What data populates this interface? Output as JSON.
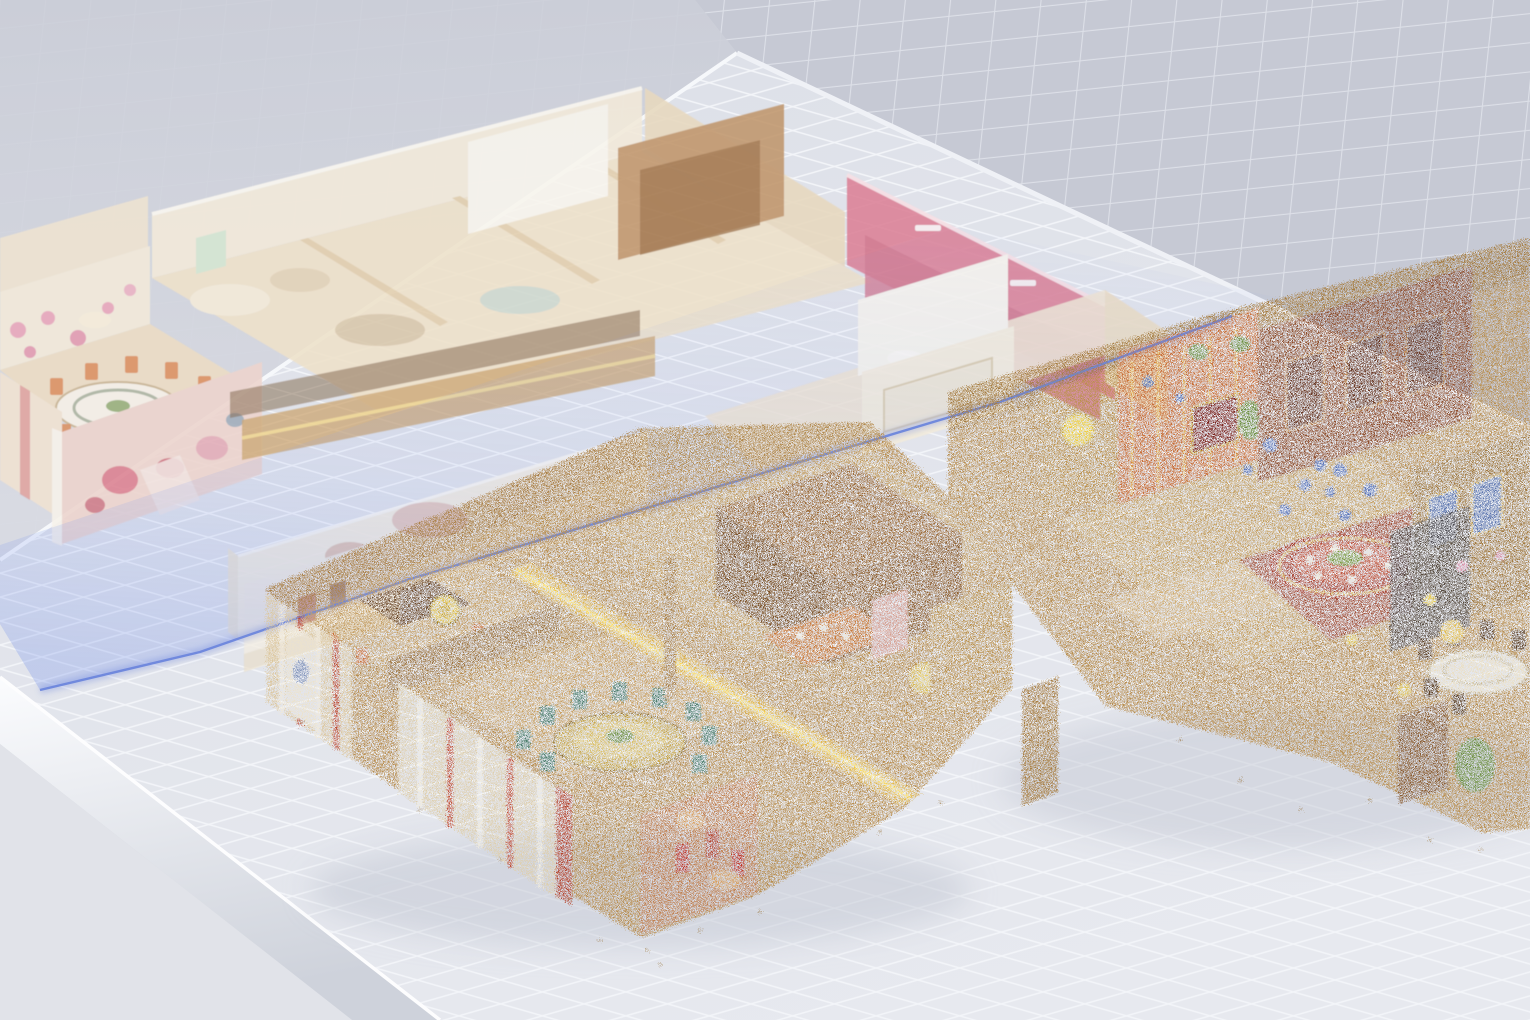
{
  "app": {
    "name": "3d-scan-viewer",
    "view": "dollhouse-split-floor-view"
  },
  "scene": {
    "models": [
      {
        "id": "upper-floor",
        "kind": "textured-mesh-faded"
      },
      {
        "id": "lower-floor",
        "kind": "point-cloud"
      }
    ],
    "slice_plane": {
      "id": "floor-slice-plane"
    }
  },
  "colors": {
    "backdrop_wall": "#c6c9d4",
    "backdrop_wall_line": "#dde0e8",
    "backdrop_left_top": "#cbced8",
    "backdrop_left_bottom": "#d9dbe3",
    "floor_top": "#dde0e8",
    "floor_bottom": "#e7e9ef",
    "floor_line": "#f3f5f9",
    "slab_edge_top": "#fbfcfe",
    "slab_edge_bottom": "#ced2db",
    "slab_side": "#e1e3e9",
    "plane_fill": "rgba(118,146,234,0.30)",
    "plane_fill_mid": "rgba(140,164,238,0.14)",
    "plane_fill_far": "rgba(156,176,242,0.04)",
    "plane_edge": "#6d86dc",
    "upper_cream": "#f2e9da",
    "upper_tan": "#e7d8bf",
    "upper_wood": "#bf9468",
    "upper_red": "#dc8398",
    "upper_floor_warm": "#eee1ca",
    "upper_white": "#f8f4ec",
    "upper_teal": "#bfdfd9",
    "upper_corridor": "#caa36b",
    "upper_corridor_glow": "#f0d793",
    "upper_mural_pink": "#ecd4cd",
    "cloud_base": "#b98f51",
    "cloud_dark": "#8f6132",
    "cloud_tan": "#d2b078",
    "cloud_brown": "#9c6b38",
    "cloud_orange": "#c96f38",
    "cloud_red": "#b5452f",
    "cloud_mural": "#c08050",
    "cloud_teal": "#4e7f6d",
    "cloud_blue": "#5571b8",
    "cloud_yellow": "#f0cf3c",
    "cloud_glow": "#ffdf5e",
    "cloud_green": "#6d8f3f",
    "cloud_table_red": "#a8402f",
    "cloud_cream": "#eadfc4",
    "shadow": "#c2c6d1"
  }
}
